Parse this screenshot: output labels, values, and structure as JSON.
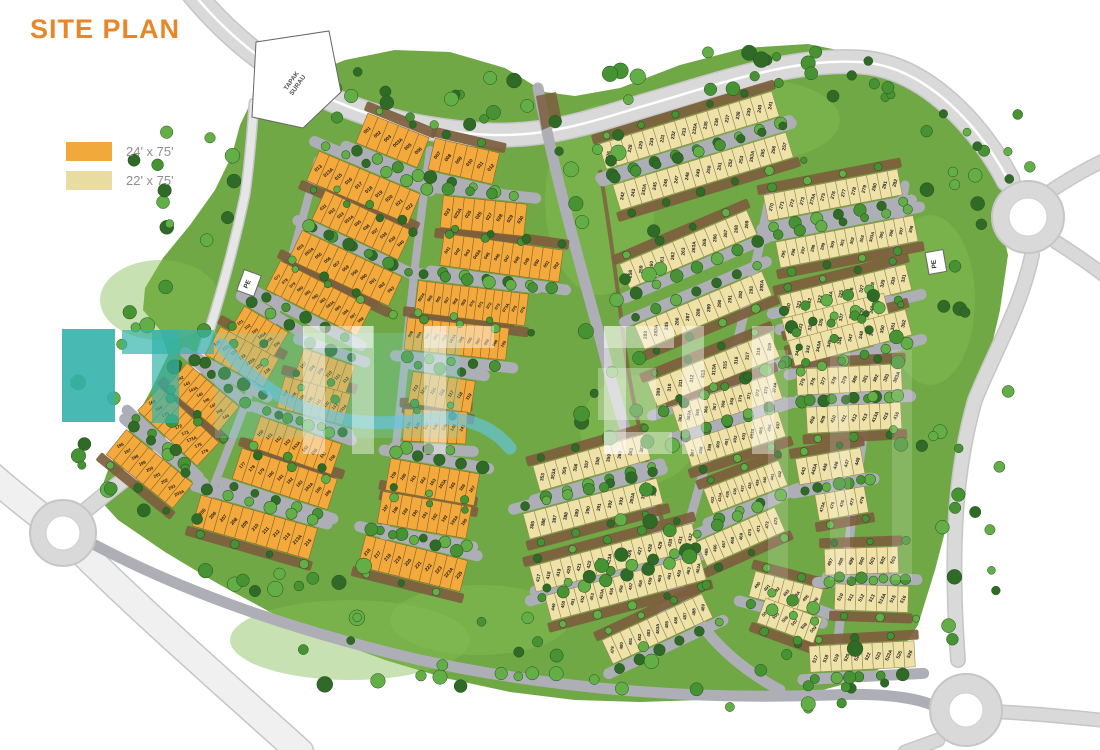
{
  "title": "SITE PLAN",
  "legend": [
    {
      "label": "24' x 75'",
      "swatch_color": "#F2A93C"
    },
    {
      "label": "22' x 75'",
      "swatch_color": "#E9DCA0"
    }
  ],
  "labels": {
    "tapak_surau": "TAPAK SURAU",
    "pe_left": "PE",
    "pe_right": "PE"
  },
  "colors": {
    "title": "#E8872A",
    "legend_text": "#8F8F8F",
    "lot24": "#F4A93C",
    "lot24_stroke": "#8A6A30",
    "lot22": "#EFE2A9",
    "lot22_stroke": "#9A8A52",
    "green": "#6FA844",
    "green_light": "#86BD55",
    "road": "#AEAEB6",
    "road_major": "#D9D9D9",
    "road_casing": "#C6C6C6",
    "dirt": "#7D5E3E",
    "tree_dark": "#2F6B27",
    "tree_mid": "#479334",
    "tree_light": "#63AE46",
    "lot_label": "#1C1C1C",
    "plot_outline": "#666666",
    "watermark_teal": "#35B3AB",
    "watermark_blue": "#66C4E4",
    "watermark_mint": "#7FD9C4"
  },
  "map": {
    "rows": [
      {
        "t": "24",
        "x": 367,
        "y": 130,
        "a": 22,
        "w": 11,
        "f": 1,
        "lots": [
          "001",
          "002",
          "003",
          "003A",
          "005",
          "006"
        ]
      },
      {
        "t": "24",
        "x": 437,
        "y": 155,
        "a": 13,
        "w": 11,
        "f": 1,
        "lots": [
          "007",
          "008",
          "009",
          "010",
          "011",
          "012"
        ]
      },
      {
        "t": "24",
        "x": 318,
        "y": 168,
        "a": 23,
        "w": 11,
        "f": -1,
        "lots": [
          "013",
          "013A",
          "015",
          "016",
          "017",
          "018",
          "019",
          "020",
          "021",
          "022"
        ]
      },
      {
        "t": "24",
        "x": 447,
        "y": 212,
        "a": 6,
        "w": 10.5,
        "f": -1,
        "lots": [
          "023",
          "023A",
          "025",
          "026",
          "027",
          "028",
          "029",
          "030"
        ]
      },
      {
        "t": "24",
        "x": 323,
        "y": 207,
        "a": 25,
        "w": 9.5,
        "f": 1,
        "lots": [
          "031",
          "032",
          "033",
          "033A",
          "035",
          "036",
          "037",
          "038",
          "039",
          "040"
        ]
      },
      {
        "t": "24",
        "x": 447,
        "y": 250,
        "a": 8,
        "w": 10,
        "f": 1,
        "lots": [
          "041",
          "042",
          "043",
          "043A",
          "045",
          "046",
          "047",
          "048",
          "049",
          "050",
          "051",
          "052"
        ]
      },
      {
        "t": "24",
        "x": 300,
        "y": 247,
        "a": 25,
        "w": 10,
        "f": -1,
        "lots": [
          "053",
          "053A",
          "055",
          "056",
          "057",
          "058",
          "059",
          "060",
          "061",
          "062",
          "063"
        ]
      },
      {
        "t": "24",
        "x": 421,
        "y": 297,
        "a": 7,
        "w": 8.5,
        "f": -1,
        "lots": [
          "063A",
          "065",
          "066",
          "067",
          "068",
          "069",
          "070",
          "071",
          "072",
          "073",
          "073A",
          "075",
          "076"
        ]
      },
      {
        "t": "24",
        "x": 277,
        "y": 277,
        "a": 27,
        "w": 8.5,
        "f": 1,
        "lots": [
          "077",
          "078",
          "079",
          "080",
          "081",
          "082",
          "083",
          "083A",
          "085",
          "086",
          "087",
          "088"
        ]
      },
      {
        "t": "24",
        "x": 410,
        "y": 334,
        "a": 6,
        "w": 8.5,
        "f": 1,
        "lots": [
          "089",
          "090",
          "091",
          "092",
          "093",
          "093A",
          "095",
          "096",
          "097",
          "098",
          "099",
          "100"
        ]
      },
      {
        "t": "24",
        "x": 240,
        "y": 322,
        "a": 31,
        "w": 8.5,
        "f": -1,
        "lots": [
          "101",
          "102",
          "103",
          "103A",
          "105",
          "106"
        ]
      },
      {
        "t": "24",
        "x": 303,
        "y": 365,
        "a": 19,
        "w": 9,
        "f": -1,
        "lots": [
          "107",
          "108",
          "109",
          "110",
          "111",
          "112"
        ]
      },
      {
        "t": "24",
        "x": 415,
        "y": 388,
        "a": 9,
        "w": 9,
        "f": -1,
        "lots": [
          "113",
          "113A",
          "115",
          "116",
          "117",
          "118",
          "119"
        ]
      },
      {
        "t": "24",
        "x": 217,
        "y": 343,
        "a": 29,
        "w": 9.5,
        "f": 1,
        "lots": [
          "120",
          "121",
          "122",
          "123",
          "123A",
          "125",
          "126"
        ]
      },
      {
        "t": "24",
        "x": 285,
        "y": 393,
        "a": 15,
        "w": 8.5,
        "f": 1,
        "lots": [
          "127",
          "128",
          "129",
          "130",
          "131",
          "132",
          "133",
          "133A"
        ]
      },
      {
        "t": "24",
        "x": 408,
        "y": 425,
        "a": 3,
        "w": 9,
        "f": 1,
        "lots": [
          "135",
          "136",
          "137",
          "138",
          "139",
          "140",
          "141"
        ]
      },
      {
        "t": "24",
        "x": 180,
        "y": 378,
        "a": 40,
        "w": 8.5,
        "f": -1,
        "lots": [
          "142",
          "143",
          "143A",
          "145",
          "146",
          "147",
          "148",
          "149"
        ]
      },
      {
        "t": "24",
        "x": 260,
        "y": 433,
        "a": 19,
        "w": 9.5,
        "f": -1,
        "lots": [
          "150",
          "151",
          "152",
          "153",
          "153A",
          "155",
          "156",
          "157",
          "158"
        ]
      },
      {
        "t": "24",
        "x": 393,
        "y": 475,
        "a": 10,
        "w": 10,
        "f": -1,
        "lots": [
          "159",
          "160",
          "161",
          "162",
          "163",
          "163A",
          "165",
          "166",
          "167"
        ]
      },
      {
        "t": "24",
        "x": 152,
        "y": 402,
        "a": 43,
        "w": 9,
        "f": 1,
        "lots": [
          "168",
          "169",
          "170",
          "171",
          "172",
          "173",
          "173A",
          "175",
          "176"
        ]
      },
      {
        "t": "24",
        "x": 242,
        "y": 465,
        "a": 18,
        "w": 10,
        "f": 1,
        "lots": [
          "177",
          "178",
          "179",
          "180",
          "181",
          "182",
          "183",
          "183A",
          "185",
          "186"
        ]
      },
      {
        "t": "24",
        "x": 385,
        "y": 508,
        "a": 10,
        "w": 10,
        "f": 1,
        "lots": [
          "187",
          "188",
          "189",
          "190",
          "191",
          "192",
          "193",
          "193A",
          "195"
        ]
      },
      {
        "t": "24",
        "x": 120,
        "y": 445,
        "a": 39,
        "w": 9.5,
        "f": -1,
        "lots": [
          "196",
          "197",
          "198",
          "199",
          "200",
          "201",
          "202",
          "203",
          "203A"
        ]
      },
      {
        "t": "24",
        "x": 202,
        "y": 512,
        "a": 16,
        "w": 11,
        "f": -1,
        "lots": [
          "205",
          "206",
          "207",
          "208",
          "209",
          "210",
          "211",
          "212",
          "213",
          "213A",
          "215"
        ]
      },
      {
        "t": "24",
        "x": 367,
        "y": 552,
        "a": 14,
        "w": 10.5,
        "f": -1,
        "lots": [
          "216",
          "217",
          "218",
          "219",
          "220",
          "221",
          "222",
          "223",
          "223A",
          "225"
        ]
      },
      {
        "t": "22",
        "x": 608,
        "y": 155,
        "a": -17,
        "w": 11.3,
        "f": 1,
        "lots": [
          "226",
          "227",
          "228",
          "229",
          "230",
          "231",
          "232",
          "233",
          "233A",
          "235",
          "236",
          "237",
          "238",
          "239",
          "240",
          "241"
        ]
      },
      {
        "t": "22",
        "x": 622,
        "y": 196,
        "a": -17,
        "w": 11.3,
        "f": -1,
        "lots": [
          "242",
          "243",
          "243A",
          "245",
          "246",
          "247",
          "248",
          "249",
          "250",
          "251",
          "252",
          "253",
          "253A",
          "255",
          "256",
          "257"
        ]
      },
      {
        "t": "22",
        "x": 630,
        "y": 274,
        "a": -23,
        "w": 11.5,
        "f": 1,
        "lots": [
          "258",
          "259",
          "260",
          "261",
          "262",
          "263",
          "263A",
          "265",
          "266",
          "267",
          "268",
          "269"
        ]
      },
      {
        "t": "22",
        "x": 771,
        "y": 207,
        "a": -11,
        "w": 10.5,
        "f": 1,
        "lots": [
          "270",
          "271",
          "272",
          "273",
          "273A",
          "275",
          "276",
          "277",
          "278",
          "279",
          "280",
          "281",
          "282"
        ]
      },
      {
        "t": "22",
        "x": 645,
        "y": 335,
        "a": -23,
        "w": 11.5,
        "f": -1,
        "lots": [
          "283",
          "283A",
          "285",
          "286",
          "287",
          "288",
          "289",
          "290",
          "291",
          "292",
          "293",
          "293A"
        ]
      },
      {
        "t": "22",
        "x": 783,
        "y": 254,
        "a": -11,
        "w": 10,
        "f": -1,
        "lots": [
          "295",
          "296",
          "297",
          "298",
          "299",
          "300",
          "301",
          "302",
          "303",
          "303A",
          "305",
          "306",
          "307",
          "308"
        ]
      },
      {
        "t": "22",
        "x": 658,
        "y": 392,
        "a": -22,
        "w": 12,
        "f": 1,
        "lots": [
          "309",
          "310",
          "311",
          "312",
          "313",
          "313A",
          "315",
          "316",
          "317",
          "318",
          "319"
        ]
      },
      {
        "t": "22",
        "x": 788,
        "y": 307,
        "a": -14,
        "w": 10.8,
        "f": 1,
        "lots": [
          "320",
          "321",
          "322",
          "323",
          "323A",
          "325",
          "326",
          "327",
          "328",
          "329",
          "330",
          "331"
        ]
      },
      {
        "t": "22",
        "x": 790,
        "y": 330,
        "a": -14,
        "w": 10.5,
        "f": -1,
        "lots": [
          "332",
          "333",
          "333A",
          "335",
          "336",
          "337",
          "338",
          "339",
          "340",
          "341"
        ]
      },
      {
        "t": "22",
        "x": 797,
        "y": 352,
        "a": -15,
        "w": 11,
        "f": 1,
        "lots": [
          "342",
          "343",
          "343A",
          "345",
          "346",
          "347",
          "348",
          "349",
          "350",
          "351",
          "352"
        ]
      },
      {
        "t": "22",
        "x": 542,
        "y": 477,
        "a": -16,
        "w": 11.5,
        "f": 1,
        "lots": [
          "353",
          "353A",
          "355",
          "356",
          "357",
          "358",
          "359",
          "360",
          "361",
          "362"
        ]
      },
      {
        "t": "22",
        "x": 680,
        "y": 418,
        "a": -18,
        "w": 9,
        "f": 1,
        "lots": [
          "363",
          "363A",
          "365",
          "366",
          "367",
          "368",
          "369",
          "370",
          "371",
          "372",
          "373",
          "373A"
        ]
      },
      {
        "t": "22",
        "x": 802,
        "y": 382,
        "a": -3,
        "w": 10.5,
        "f": 1,
        "lots": [
          "375",
          "376",
          "377",
          "378",
          "379",
          "380",
          "381",
          "382",
          "383",
          "383A"
        ]
      },
      {
        "t": "22",
        "x": 532,
        "y": 525,
        "a": -15,
        "w": 11.5,
        "f": -1,
        "lots": [
          "385",
          "386",
          "387",
          "388",
          "389",
          "390",
          "391",
          "392",
          "393",
          "393A",
          "395",
          "396"
        ]
      },
      {
        "t": "22",
        "x": 692,
        "y": 453,
        "a": -18,
        "w": 9,
        "f": -1,
        "lots": [
          "397",
          "398",
          "399",
          "400",
          "401",
          "402",
          "403",
          "403A",
          "405",
          "406",
          "407"
        ]
      },
      {
        "t": "22",
        "x": 812,
        "y": 420,
        "a": -3,
        "w": 10.5,
        "f": -1,
        "lots": [
          "408",
          "409",
          "410",
          "411",
          "412",
          "413",
          "413A",
          "415",
          "416"
        ]
      },
      {
        "t": "22",
        "x": 538,
        "y": 578,
        "a": -15,
        "w": 10.5,
        "f": 1,
        "lots": [
          "417",
          "418",
          "419",
          "420",
          "421",
          "422",
          "423",
          "423A",
          "425",
          "426",
          "427",
          "428",
          "429",
          "430",
          "431",
          "432"
        ]
      },
      {
        "t": "22",
        "x": 712,
        "y": 500,
        "a": -21,
        "w": 8,
        "f": 1,
        "lots": [
          "433",
          "433A",
          "435",
          "436",
          "437",
          "438",
          "439",
          "440",
          "441",
          "442"
        ]
      },
      {
        "t": "22",
        "x": 803,
        "y": 471,
        "a": -10,
        "w": 11,
        "f": 1,
        "lots": [
          "443",
          "443A",
          "445",
          "446",
          "447",
          "448"
        ]
      },
      {
        "t": "22",
        "x": 553,
        "y": 607,
        "a": -15,
        "w": 10,
        "f": -1,
        "lots": [
          "449",
          "450",
          "451",
          "452",
          "453",
          "453A",
          "455",
          "456",
          "457",
          "458",
          "459",
          "460",
          "461",
          "462",
          "463",
          "463A"
        ]
      },
      {
        "t": "22",
        "x": 706,
        "y": 552,
        "a": -24,
        "w": 9.5,
        "f": -1,
        "lots": [
          "465",
          "466",
          "467",
          "468",
          "469",
          "470",
          "471",
          "472",
          "473"
        ]
      },
      {
        "t": "22",
        "x": 822,
        "y": 507,
        "a": -10,
        "w": 10,
        "f": -1,
        "lots": [
          "473A",
          "475",
          "476",
          "477",
          "478"
        ]
      },
      {
        "t": "22",
        "x": 612,
        "y": 650,
        "a": -25,
        "w": 10,
        "f": 1,
        "lots": [
          "479",
          "480",
          "481",
          "482",
          "483",
          "483A",
          "485",
          "486",
          "487",
          "488",
          "489"
        ]
      },
      {
        "t": "22",
        "x": 757,
        "y": 585,
        "a": 15,
        "w": 10,
        "f": 1,
        "lots": [
          "490",
          "491",
          "492",
          "493",
          "493A",
          "495",
          "496"
        ]
      },
      {
        "t": "22",
        "x": 830,
        "y": 562,
        "a": -2,
        "w": 10.5,
        "f": 1,
        "lots": [
          "497",
          "498",
          "499",
          "500",
          "501",
          "502",
          "503"
        ]
      },
      {
        "t": "22",
        "x": 766,
        "y": 612,
        "a": 20,
        "w": 10,
        "f": -1,
        "lots": [
          "503A",
          "505",
          "506",
          "507",
          "508",
          "509"
        ]
      },
      {
        "t": "22",
        "x": 840,
        "y": 597,
        "a": 2,
        "w": 10.5,
        "f": -1,
        "lots": [
          "510",
          "511",
          "512",
          "513",
          "513A",
          "515",
          "516"
        ]
      },
      {
        "t": "22",
        "x": 815,
        "y": 659,
        "a": -3,
        "w": 10.5,
        "f": 1,
        "lots": [
          "517",
          "518",
          "519",
          "520",
          "521",
          "522",
          "523",
          "523A",
          "525",
          "526"
        ]
      }
    ]
  }
}
